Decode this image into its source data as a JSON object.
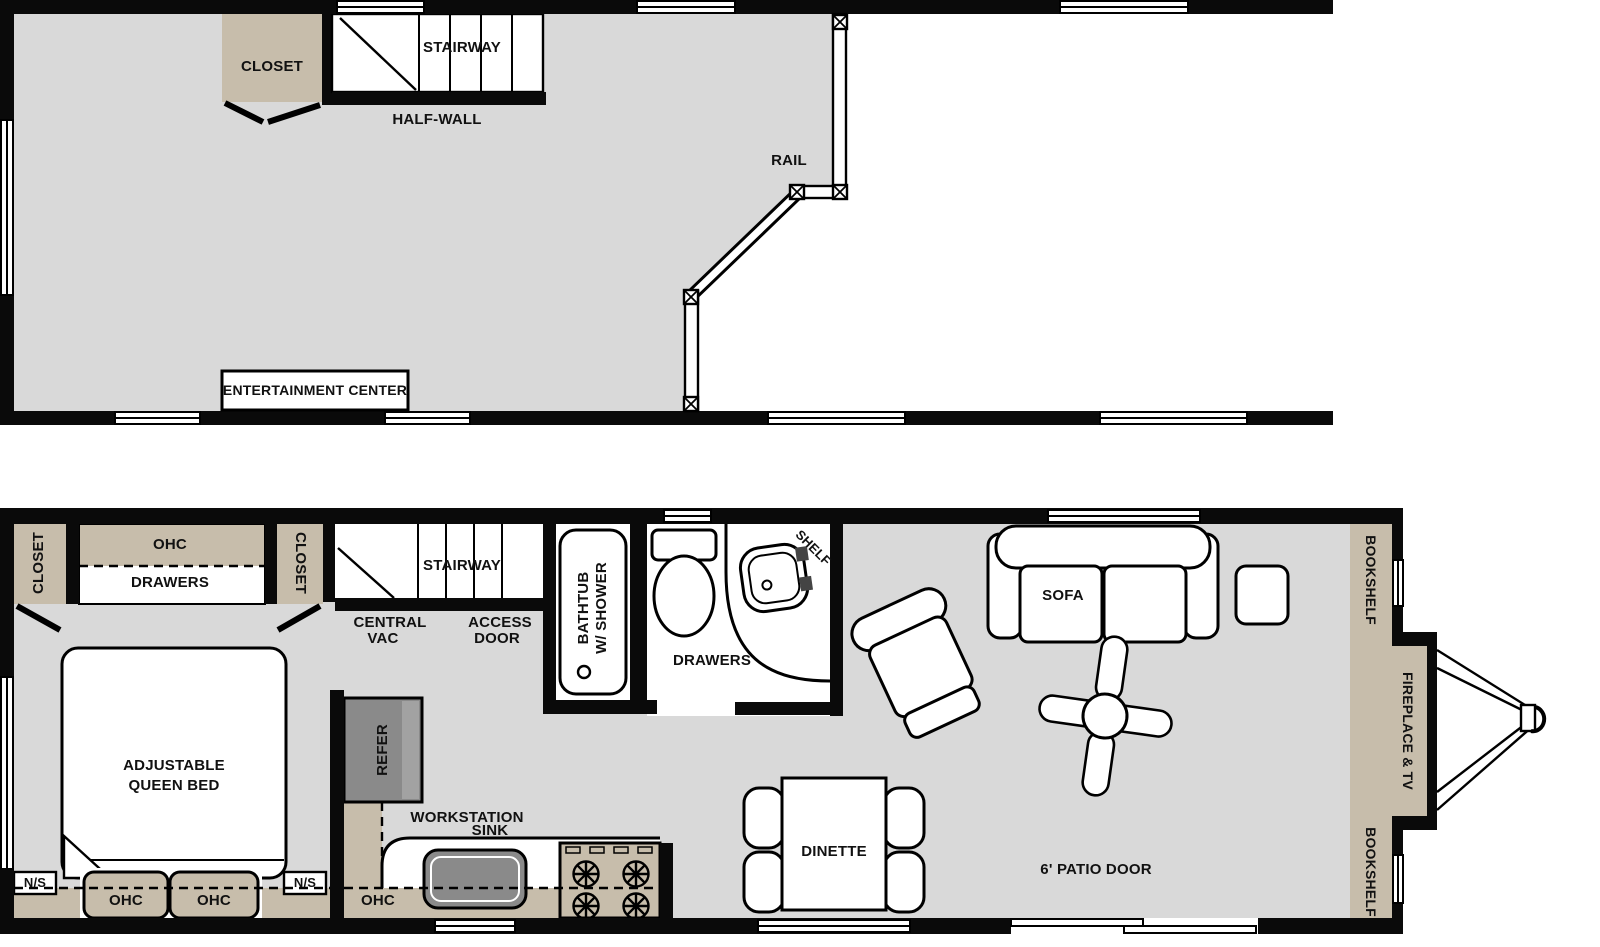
{
  "title": "Park model floor plan (loft level and main level)",
  "colors": {
    "wall": "#0a0a0a",
    "floor": "#d9d9d9",
    "cabinet": "#c7bdab",
    "appliance": "#8a8a8a",
    "background": "#ffffff",
    "outline": "#000000"
  },
  "upper_floor": {
    "labels": {
      "closet": "CLOSET",
      "stairway": "STAIRWAY",
      "half_wall": "HALF-WALL",
      "rail": "RAIL",
      "entertainment_center": "ENTERTAINMENT CENTER"
    }
  },
  "main_floor": {
    "labels": {
      "closet_left": "CLOSET",
      "ohc_top": "OHC",
      "drawers_bedroom": "DRAWERS",
      "closet_right": "CLOSET",
      "stairway": "STAIRWAY",
      "central_vac_line1": "CENTRAL",
      "central_vac_line2": "VAC",
      "access_door_line1": "ACCESS",
      "access_door_line2": "DOOR",
      "bathtub_line1": "BATHTUB",
      "bathtub_line2": "W/ SHOWER",
      "shelf": "SHELF",
      "drawers_bath": "DRAWERS",
      "bed_line1": "ADJUSTABLE",
      "bed_line2": "QUEEN BED",
      "ns_left": "N/S",
      "ns_right": "N/S",
      "ohc_bed_left": "OHC",
      "ohc_bed_right": "OHC",
      "refer": "REFER",
      "workstation_line1": "WORKSTATION",
      "workstation_line2": "SINK",
      "ohc_kitchen": "OHC",
      "dinette": "DINETTE",
      "sofa": "SOFA",
      "patio_door": "6' PATIO DOOR",
      "bookshelf_top": "BOOKSHELF",
      "fireplace_tv": "FIREPLACE & TV",
      "bookshelf_bottom": "BOOKSHELF"
    }
  }
}
